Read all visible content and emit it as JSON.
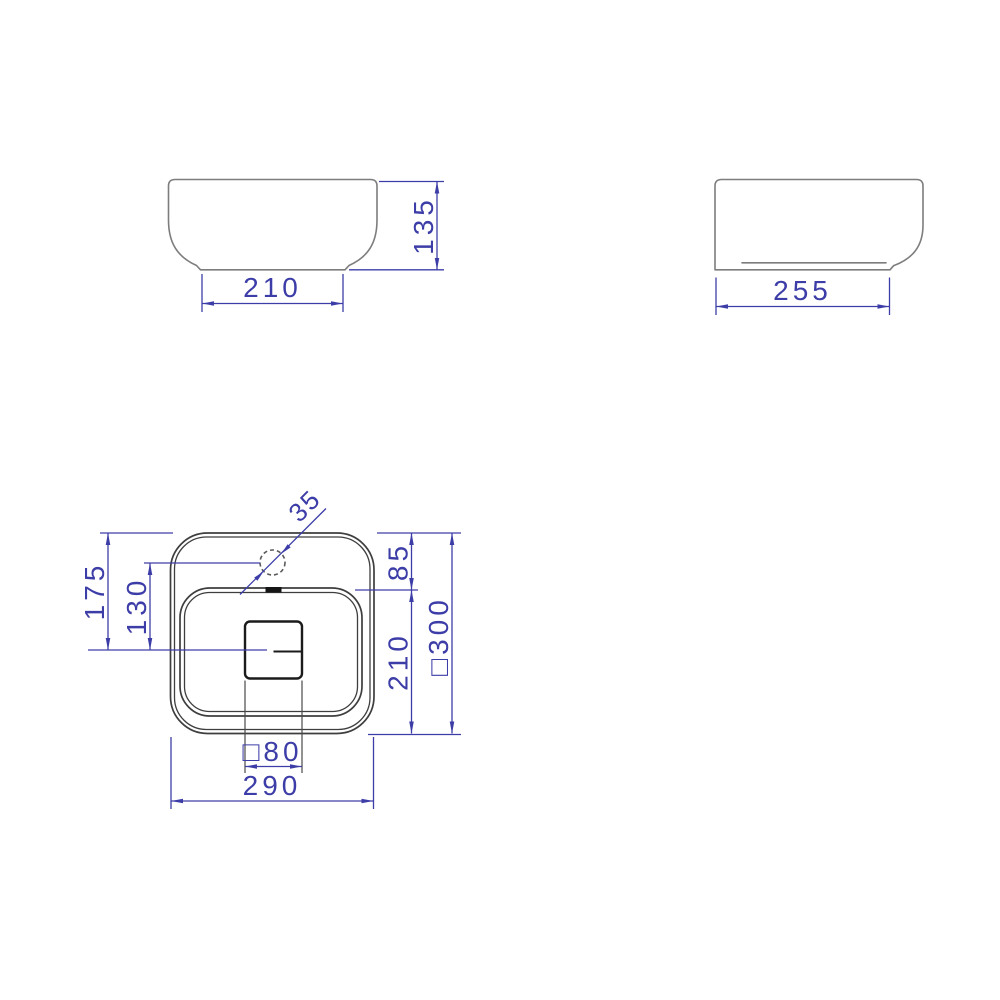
{
  "drawing": {
    "type": "technical-orthographic-views",
    "subject": "countertop washbasin dimensional drawing",
    "colors": {
      "background": "#ffffff",
      "dimension_blue": "#3d3da8",
      "object_gray": "#7d7d7d",
      "object_dark": "#3e3e3e",
      "drain_black": "#1b1b1b"
    },
    "front_view": {
      "base_width_label": "210",
      "height_label": "135"
    },
    "side_view": {
      "depth_label": "255"
    },
    "plan_view": {
      "overall_width_label": "290",
      "overall_square_label": "□300",
      "center_from_back_label": "175",
      "faucet_to_center_label": "130",
      "deck_depth_label": "85",
      "basin_depth_label": "210",
      "drain_square_label": "□80",
      "faucet_diameter_label": "35"
    }
  }
}
